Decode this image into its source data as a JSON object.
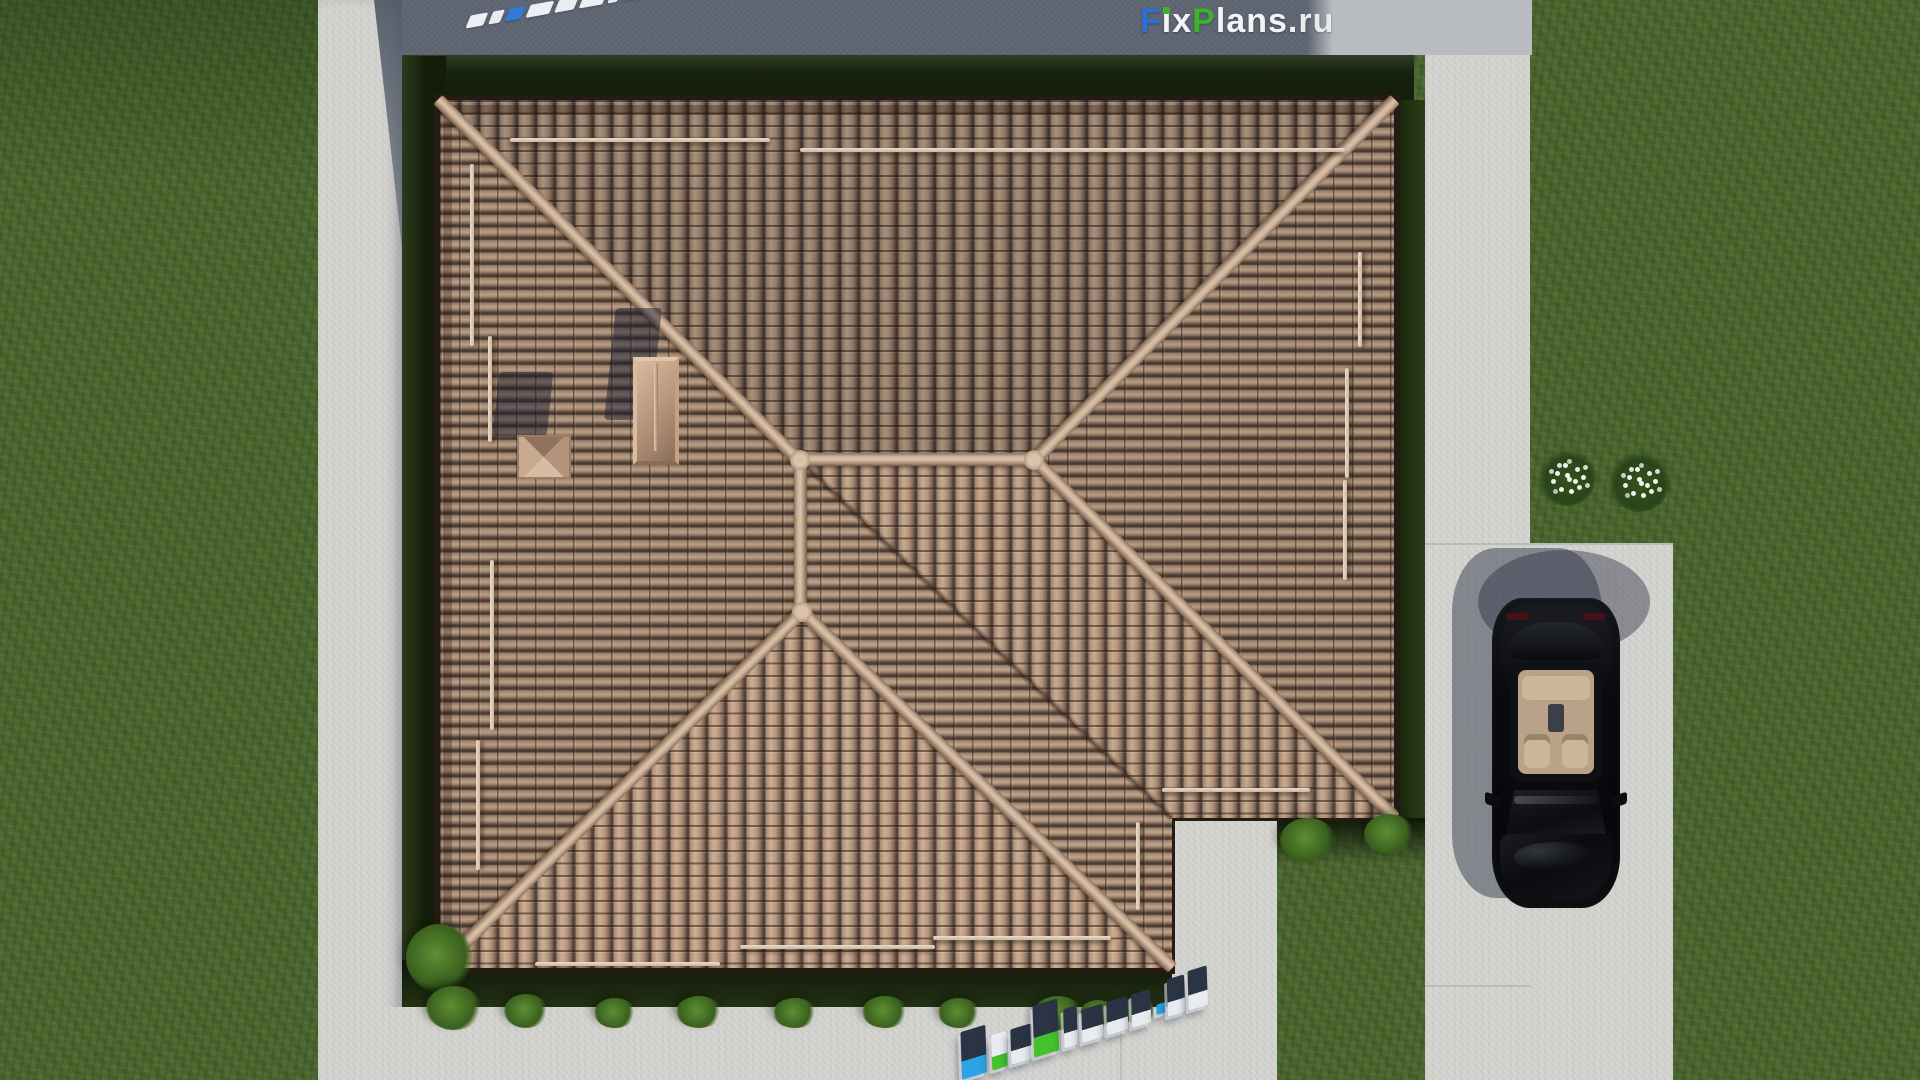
{
  "site": {
    "brand": "FixPlans.ru"
  },
  "watermarks": {
    "top_right": {
      "text": "FixPlans.ru",
      "letters": [
        {
          "ch": "F",
          "color": "#2e6fd6"
        },
        {
          "ch": "i",
          "color": "#f2f4f7",
          "dot": "#3cb32a"
        },
        {
          "ch": "x",
          "color": "#f2f4f7"
        },
        {
          "ch": "P",
          "color": "#3cb32a"
        },
        {
          "ch": "l",
          "color": "#f2f4f7"
        },
        {
          "ch": "a",
          "color": "#f2f4f7"
        },
        {
          "ch": "n",
          "color": "#f2f4f7"
        },
        {
          "ch": "s",
          "color": "#f2f4f7"
        },
        {
          "ch": ".",
          "color": "#eef0f2"
        },
        {
          "ch": "r",
          "color": "#e8eaec"
        },
        {
          "ch": "u",
          "color": "#e8eaec"
        }
      ]
    },
    "top_left": {
      "text": "FixPlans.ru",
      "segments": [
        {
          "w": 18,
          "color": "#eceff3"
        },
        {
          "w": 12,
          "color": "#e7ebf0"
        },
        {
          "w": 16,
          "color": "#2f7bd6"
        },
        {
          "w": 24,
          "color": "#eceff3"
        },
        {
          "w": 20,
          "color": "#e9edf2"
        },
        {
          "w": 24,
          "color": "#eceff3"
        },
        {
          "w": 10,
          "color": "#e7ebf0"
        },
        {
          "w": 30,
          "color": "#3db32c"
        },
        {
          "w": 18,
          "color": "#eceff3"
        },
        {
          "w": 20,
          "color": "#e9edf2"
        },
        {
          "w": 16,
          "color": "#eceff3"
        }
      ]
    },
    "bottom": {
      "text": "FixPlans.ru",
      "blocks": [
        {
          "ch": "F",
          "w": 26,
          "h": 46,
          "top": "#2b3444",
          "base": "#2aa4e6"
        },
        {
          "ch": "i",
          "w": 16,
          "h": 34,
          "top": "#e9edf1",
          "base": "#43c22b"
        },
        {
          "ch": "x",
          "w": 22,
          "h": 34,
          "top": "#2b3444",
          "base": "#e8ecf0"
        },
        {
          "ch": "P",
          "w": 26,
          "h": 50,
          "top": "#2b3444",
          "base": "#43c22b"
        },
        {
          "ch": "l",
          "w": 14,
          "h": 38,
          "top": "#2b3444",
          "base": "#e8ecf0"
        },
        {
          "ch": "a",
          "w": 22,
          "h": 32,
          "top": "#2b3444",
          "base": "#e8ecf0"
        },
        {
          "ch": "n",
          "w": 22,
          "h": 32,
          "top": "#2b3444",
          "base": "#e8ecf0"
        },
        {
          "ch": "s",
          "w": 20,
          "h": 32,
          "top": "#2b3444",
          "base": "#e8ecf0"
        },
        {
          "ch": ".",
          "w": 10,
          "h": 10,
          "top": "#2aa4e6",
          "base": "#2aa4e6"
        },
        {
          "ch": "r",
          "w": 18,
          "h": 36,
          "top": "#2b3444",
          "base": "#e8ecf0"
        },
        {
          "ch": "u",
          "w": 20,
          "h": 38,
          "top": "#2b3444",
          "base": "#e8ecf0"
        }
      ]
    }
  },
  "palette": {
    "grass": "#4c6830",
    "grass_shadow": "#17220e",
    "concrete": "#d4d4d1",
    "concrete_shadow": "#5e6572",
    "roof_tile": "#977d6b",
    "ridge_cap": "#cdb29a",
    "car_body": "#0c0d11",
    "car_interior": "#b9a287",
    "logo_blue": "#2e6fd6",
    "logo_green": "#3cb32a"
  },
  "vegetation": {
    "bushes": [
      {
        "x": 406,
        "y": 924,
        "w": 66,
        "h": 68
      },
      {
        "x": 426,
        "y": 986,
        "w": 56,
        "h": 44
      },
      {
        "x": 504,
        "y": 994,
        "w": 44,
        "h": 34
      },
      {
        "x": 594,
        "y": 998,
        "w": 42,
        "h": 30
      },
      {
        "x": 676,
        "y": 996,
        "w": 46,
        "h": 32
      },
      {
        "x": 773,
        "y": 998,
        "w": 44,
        "h": 30
      },
      {
        "x": 862,
        "y": 996,
        "w": 46,
        "h": 32
      },
      {
        "x": 938,
        "y": 998,
        "w": 42,
        "h": 30
      },
      {
        "x": 1034,
        "y": 996,
        "w": 48,
        "h": 34
      },
      {
        "x": 1080,
        "y": 1000,
        "w": 36,
        "h": 26
      },
      {
        "x": 1122,
        "y": 998,
        "w": 34,
        "h": 26
      },
      {
        "x": 1280,
        "y": 818,
        "w": 56,
        "h": 44
      },
      {
        "x": 1364,
        "y": 814,
        "w": 50,
        "h": 40
      }
    ],
    "flowers": [
      {
        "x": 1538,
        "y": 448,
        "d": 58
      },
      {
        "x": 1608,
        "y": 450,
        "d": 62
      }
    ]
  }
}
